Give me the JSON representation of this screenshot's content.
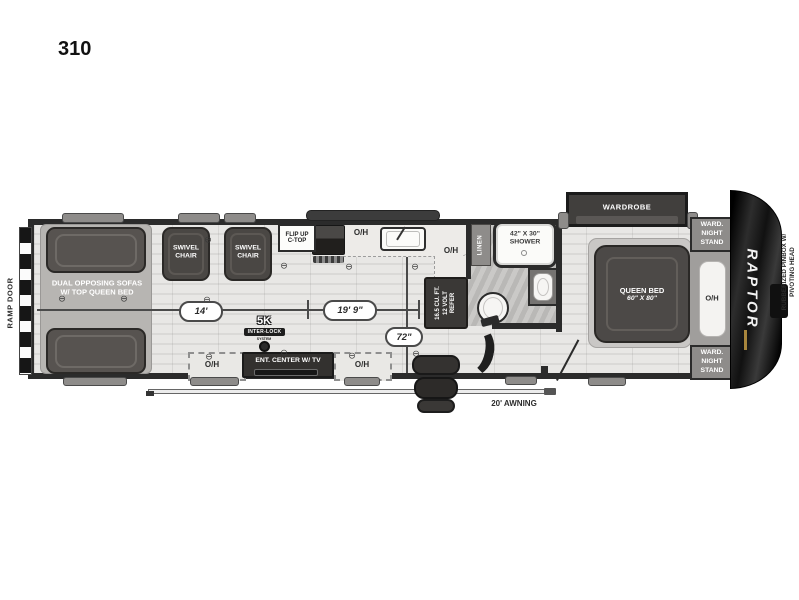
{
  "title": "310",
  "oh_label": "O/H",
  "icons": {
    "anchor": "⊖"
  },
  "ramp_door_label": "RAMP DOOR",
  "garage": {
    "sofas_line1": "DUAL OPPOSING SOFAS",
    "sofas_line2": "W/ TOP QUEEN BED",
    "swivel_line1": "SWIVEL",
    "swivel_line2": "CHAIR",
    "badge_5k": "5K",
    "badge_interlock": "INTER-LOCK",
    "badge_system": "SYSTEM"
  },
  "kitchen": {
    "flip_up_line1": "FLIP UP",
    "flip_up_line2": "C-TOP",
    "fridge_line1": "16.5 CU. FT.",
    "fridge_line2": "12 VOLT",
    "fridge_line3": "REFER"
  },
  "bathroom": {
    "linen": "LINEN",
    "shower_line1": "42\" X 30\"",
    "shower_line2": "SHOWER"
  },
  "bedroom": {
    "wardrobe": "WARDROBE",
    "queen_line1": "QUEEN BED",
    "queen_line2": "60\" X 80\"",
    "ns_line1": "WARD.",
    "ns_line2": "NIGHT",
    "ns_line3": "STAND"
  },
  "entertainment": {
    "label": "ENT. CENTER W/ TV"
  },
  "front_cap": {
    "brand": "RAPTOR",
    "pinbox_line1": "RUBBERIZED PINBOX W/",
    "pinbox_line2": "PIVOTING HEAD"
  },
  "awning_label": "20' AWNING",
  "dimensions": {
    "garage": "14'",
    "living": "19' 9\"",
    "aisle": "72\""
  },
  "colors": {
    "wall": "#2b2b2b",
    "furniture": "#4a4744",
    "floor": "#e3e2e0",
    "cap": "#0a0a0a",
    "accent_gold": "#a8863d"
  }
}
